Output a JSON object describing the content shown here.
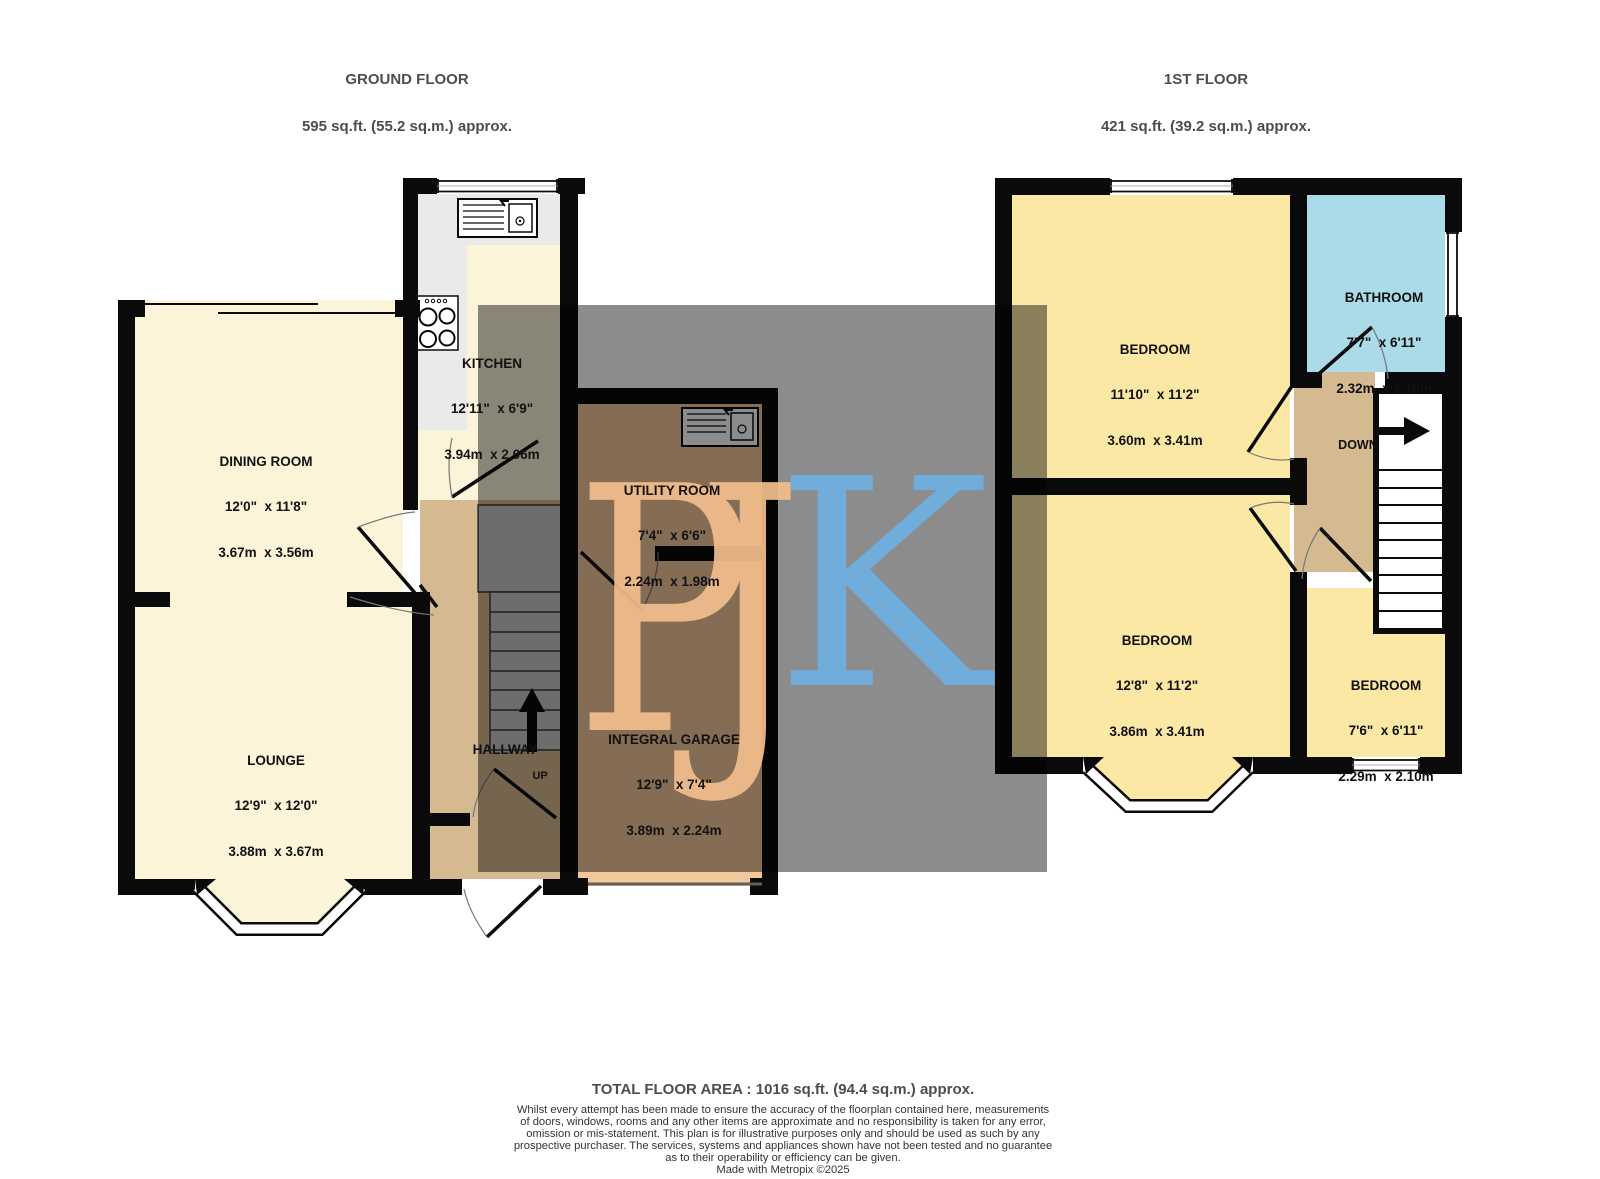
{
  "headers": {
    "ground": {
      "title": "GROUND FLOOR",
      "area": "595 sq.ft. (55.2 sq.m.) approx."
    },
    "first": {
      "title": "1ST FLOOR",
      "area": "421 sq.ft. (39.2 sq.m.) approx."
    }
  },
  "rooms": {
    "dining_room": {
      "name": "DINING ROOM",
      "imperial": "12'0\"  x 11'8\"",
      "metric": "3.67m  x 3.56m"
    },
    "kitchen": {
      "name": "KITCHEN",
      "imperial": "12'11\"  x 6'9\"",
      "metric": "3.94m  x 2.06m"
    },
    "lounge": {
      "name": "LOUNGE",
      "imperial": "12'9\"  x 12'0\"",
      "metric": "3.88m  x 3.67m"
    },
    "utility_room": {
      "name": "UTILITY ROOM",
      "imperial": "7'4\"  x 6'6\"",
      "metric": "2.24m  x 1.98m"
    },
    "integral_garage": {
      "name": "INTEGRAL GARAGE",
      "imperial": "12'9\"  x 7'4\"",
      "metric": "3.89m  x 2.24m"
    },
    "hallway": {
      "name": "HALLWAY"
    },
    "bedroom1": {
      "name": "BEDROOM",
      "imperial": "11'10\"  x 11'2\"",
      "metric": "3.60m  x 3.41m"
    },
    "bathroom": {
      "name": "BATHROOM",
      "imperial": "7'7\"  x 6'11\"",
      "metric": "2.32m  x 2.10m"
    },
    "bedroom2": {
      "name": "BEDROOM",
      "imperial": "12'8\"  x 11'2\"",
      "metric": "3.86m  x 3.41m"
    },
    "bedroom3": {
      "name": "BEDROOM",
      "imperial": "7'6\"  x 6'11\"",
      "metric": "2.29m  x 2.10m"
    }
  },
  "stairs": {
    "up_label": "UP",
    "down_label": "DOWN"
  },
  "watermark": {
    "letters_pj": "PJ",
    "letter_k": "K",
    "pj_color": "#F2BE8C",
    "k_color": "#6FB0E2",
    "overlay_color": "rgba(0,0,0,0.45)"
  },
  "colors": {
    "cream": "#FBF4D9",
    "yellow": "#FAE8A4",
    "blue": "#ABDAE9",
    "tan": "#D5B990",
    "peach": "#F3C79B",
    "kitchen_gray": "#EAEAEA"
  },
  "footer": {
    "total": "TOTAL FLOOR AREA : 1016 sq.ft. (94.4 sq.m.) approx.",
    "disclaimer": [
      "Whilst every attempt has been made to ensure the accuracy of the floorplan contained here, measurements",
      "of doors, windows, rooms and any other items are approximate and no responsibility is taken for any error,",
      "omission or mis-statement. This plan is for illustrative purposes only and should be used as such by any",
      "prospective purchaser. The services, systems and appliances shown have not been tested and no guarantee",
      "as to their operability or efficiency can be given."
    ],
    "credit": "Made with Metropix ©2025"
  }
}
